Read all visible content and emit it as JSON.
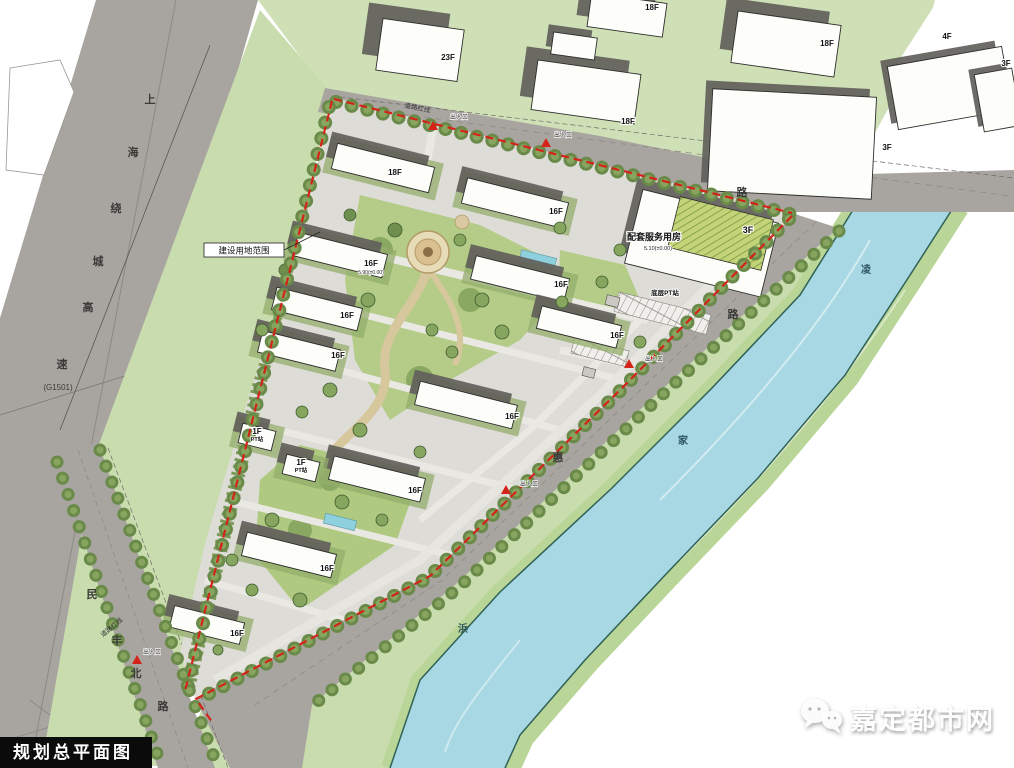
{
  "title": "规划总平面图",
  "watermark": {
    "text": "嘉定都市网",
    "icon": "wechat-bubbles-icon"
  },
  "boundary": {
    "label": "建设用地范围"
  },
  "service_building": {
    "label": "配套服务用房",
    "floors": "3F",
    "elevation": "5.10(±0.00)",
    "annex": "底层PT站"
  },
  "roads": {
    "expressway": {
      "name_chars": [
        {
          "t": "上",
          "x": 150,
          "y": 103
        },
        {
          "t": "海",
          "x": 133,
          "y": 156
        },
        {
          "t": "绕",
          "x": 116,
          "y": 212
        },
        {
          "t": "城",
          "x": 98,
          "y": 265
        },
        {
          "t": "高",
          "x": 88,
          "y": 311
        },
        {
          "t": "速",
          "x": 62,
          "y": 368
        }
      ],
      "ref": {
        "t": "(G1501)",
        "x": 58,
        "y": 390
      }
    },
    "north_road_chars": [
      {
        "t": "路",
        "x": 742,
        "y": 196
      }
    ],
    "se_road_chars": [
      {
        "t": "路",
        "x": 733,
        "y": 318
      },
      {
        "t": "惠",
        "x": 558,
        "y": 461
      }
    ],
    "sw_road_chars": [
      {
        "t": "民",
        "x": 92,
        "y": 598
      },
      {
        "t": "丰",
        "x": 117,
        "y": 644
      },
      {
        "t": "北",
        "x": 136,
        "y": 677
      },
      {
        "t": "路",
        "x": 163,
        "y": 710
      }
    ],
    "redline_labels": [
      {
        "text": "道路红线",
        "x": 417,
        "y": 110,
        "rot": 12
      },
      {
        "text": "道路红线",
        "x": 113,
        "y": 629,
        "rot": -40
      }
    ]
  },
  "river": {
    "name_chars": [
      {
        "t": "凌",
        "x": 866,
        "y": 273
      },
      {
        "t": "家",
        "x": 683,
        "y": 444
      },
      {
        "t": "浜",
        "x": 463,
        "y": 632
      }
    ]
  },
  "entrances": [
    {
      "x": 433,
      "y": 126,
      "tx": 459,
      "ty": 119,
      "text": "出入口"
    },
    {
      "x": 546,
      "y": 143,
      "tx": 563,
      "ty": 137,
      "text": "出入口"
    },
    {
      "x": 629,
      "y": 364,
      "tx": 654,
      "ty": 361,
      "text": "出入口"
    },
    {
      "x": 506,
      "y": 490,
      "tx": 529,
      "ty": 486,
      "text": "出入口"
    },
    {
      "x": 137,
      "y": 660,
      "tx": 152,
      "ty": 654,
      "text": "出入口"
    }
  ],
  "buildings": {
    "site": [
      {
        "label": "18F",
        "x": 383,
        "y": 168,
        "w": 100,
        "h": 26,
        "lx": 395,
        "ly": 175
      },
      {
        "label": "16F",
        "x": 515,
        "y": 203,
        "w": 104,
        "h": 26,
        "lx": 556,
        "ly": 214
      },
      {
        "label": "16F",
        "x": 340,
        "y": 255,
        "w": 92,
        "h": 24,
        "lx": 371,
        "ly": 266,
        "elev": "5.90(±0.00)"
      },
      {
        "label": "16F",
        "x": 520,
        "y": 279,
        "w": 96,
        "h": 24,
        "lx": 561,
        "ly": 287
      },
      {
        "label": "16F",
        "x": 317,
        "y": 309,
        "w": 88,
        "h": 23,
        "lx": 347,
        "ly": 318
      },
      {
        "label": "16F",
        "x": 579,
        "y": 327,
        "w": 82,
        "h": 23,
        "lx": 617,
        "ly": 338
      },
      {
        "label": "16F",
        "x": 299,
        "y": 351,
        "w": 80,
        "h": 22,
        "lx": 338,
        "ly": 358
      },
      {
        "label": "16F",
        "x": 466,
        "y": 405,
        "w": 100,
        "h": 24,
        "lx": 512,
        "ly": 419
      },
      {
        "label": "16F",
        "x": 377,
        "y": 479,
        "w": 94,
        "h": 24,
        "lx": 415,
        "ly": 493
      },
      {
        "label": "16F",
        "x": 289,
        "y": 555,
        "w": 92,
        "h": 24,
        "lx": 327,
        "ly": 571
      },
      {
        "label": "16F",
        "x": 207,
        "y": 625,
        "w": 72,
        "h": 22,
        "lx": 237,
        "ly": 636
      },
      {
        "label": "1F",
        "label2": "PT站",
        "x": 257,
        "y": 437,
        "w": 34,
        "h": 20,
        "lx": 257,
        "ly": 434
      },
      {
        "label": "1F",
        "label2": "PT站",
        "x": 301,
        "y": 468,
        "w": 34,
        "h": 20,
        "lx": 301,
        "ly": 465
      }
    ],
    "context": [
      {
        "label": "23F",
        "x": 420,
        "y": 50,
        "w": 82,
        "h": 52,
        "r": 8,
        "lx": 448,
        "ly": 60,
        "s": [
          -16,
          -14
        ]
      },
      {
        "label": "18F",
        "x": 586,
        "y": 92,
        "w": 104,
        "h": 50,
        "r": 8,
        "lx": 628,
        "ly": 124,
        "s": [
          -13,
          -12
        ]
      },
      {
        "label": "18F",
        "x": 627,
        "y": 15,
        "w": 76,
        "h": 34,
        "r": 8,
        "lx": 652,
        "ly": 10,
        "s": [
          -12,
          -10
        ]
      },
      {
        "label": "18F",
        "x": 786,
        "y": 44,
        "w": 104,
        "h": 52,
        "r": 8,
        "lx": 827,
        "ly": 46,
        "s": [
          -13,
          -12
        ]
      },
      {
        "label": "4F",
        "x": 950,
        "y": 88,
        "w": 116,
        "h": 64,
        "r": -10,
        "lx": 947,
        "ly": 39,
        "s": [
          -6,
          -7
        ]
      },
      {
        "label": "3F",
        "x": 998,
        "y": 100,
        "w": 38,
        "h": 58,
        "r": -10,
        "lx": 1006,
        "ly": 66,
        "s": [
          -5,
          -6
        ]
      },
      {
        "label": "3F",
        "x": 792,
        "y": 144,
        "w": 164,
        "h": 102,
        "r": 3,
        "lx": 887,
        "ly": 150,
        "s": [
          -7,
          -8
        ]
      },
      {
        "label": "",
        "x": 574,
        "y": 46,
        "w": 44,
        "h": 22,
        "r": 8,
        "s": [
          -6,
          -7
        ]
      }
    ]
  }
}
